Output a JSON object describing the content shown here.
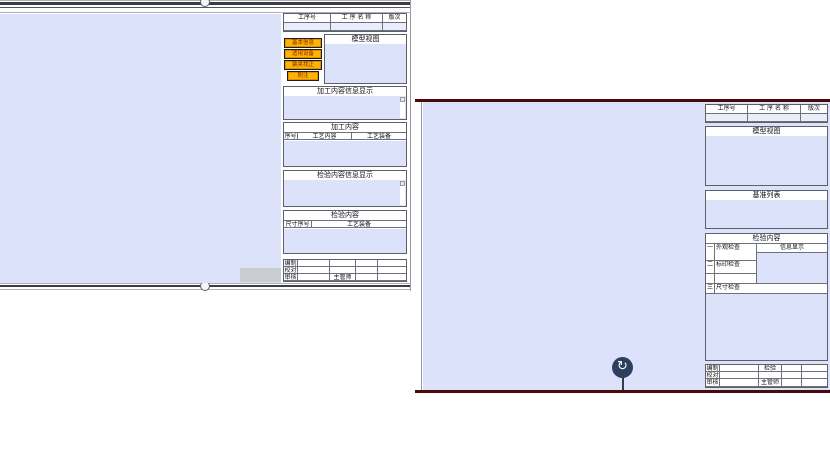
{
  "colors": {
    "panel_blue": "#dbe2fa",
    "accent_orange": "#ffb401",
    "button_text": "#7a1f00",
    "sheet_border_maroon": "#4a0808",
    "rotate_handle_navy": "#2e3f5e"
  },
  "left_sheet": {
    "process_table": {
      "col_no": "工序号",
      "col_name": "工 序 名 称",
      "col_rev": "版次"
    },
    "model_view": {
      "title": "模型视图",
      "buttons": [
        {
          "label": "基本信息"
        },
        {
          "label": "适用设备"
        },
        {
          "label": "装夹找正"
        },
        {
          "label": "附注"
        }
      ]
    },
    "machining_info_display": {
      "title": "加工内容信息显示"
    },
    "machining_content": {
      "title": "加工内容",
      "col_seq": "序号",
      "col_content": "工艺内容",
      "col_equipment": "工艺装备"
    },
    "inspection_info_display": {
      "title": "检验内容信息显示"
    },
    "inspection_content": {
      "title": "检验内容",
      "col_dim_no": "尺寸序号",
      "col_equipment": "工艺装备"
    },
    "signoff": {
      "row1_label": "编制",
      "row2_label": "校对",
      "row3_label": "审核",
      "row3_mid_label": "主管师"
    }
  },
  "right_sheet": {
    "process_table": {
      "col_no": "工序号",
      "col_name": "工 序 名 称",
      "col_rev": "版次"
    },
    "model_view": {
      "title": "模型视图"
    },
    "datum_list": {
      "title": "基准列表"
    },
    "inspection": {
      "title": "检验内容",
      "info_header": "信息显示",
      "row1_no": "一",
      "row1_label": "外观检查",
      "row2_no": "二",
      "row2_label": "标印检查",
      "row3_no": "三",
      "row3_label": "尺寸检查"
    },
    "signoff": {
      "row1_label": "编制",
      "row1_mid_label": "检验",
      "row2_label": "校对",
      "row3_label": "审核",
      "row3_mid_label": "主管师"
    }
  },
  "icons": {
    "rotate": "↻"
  }
}
